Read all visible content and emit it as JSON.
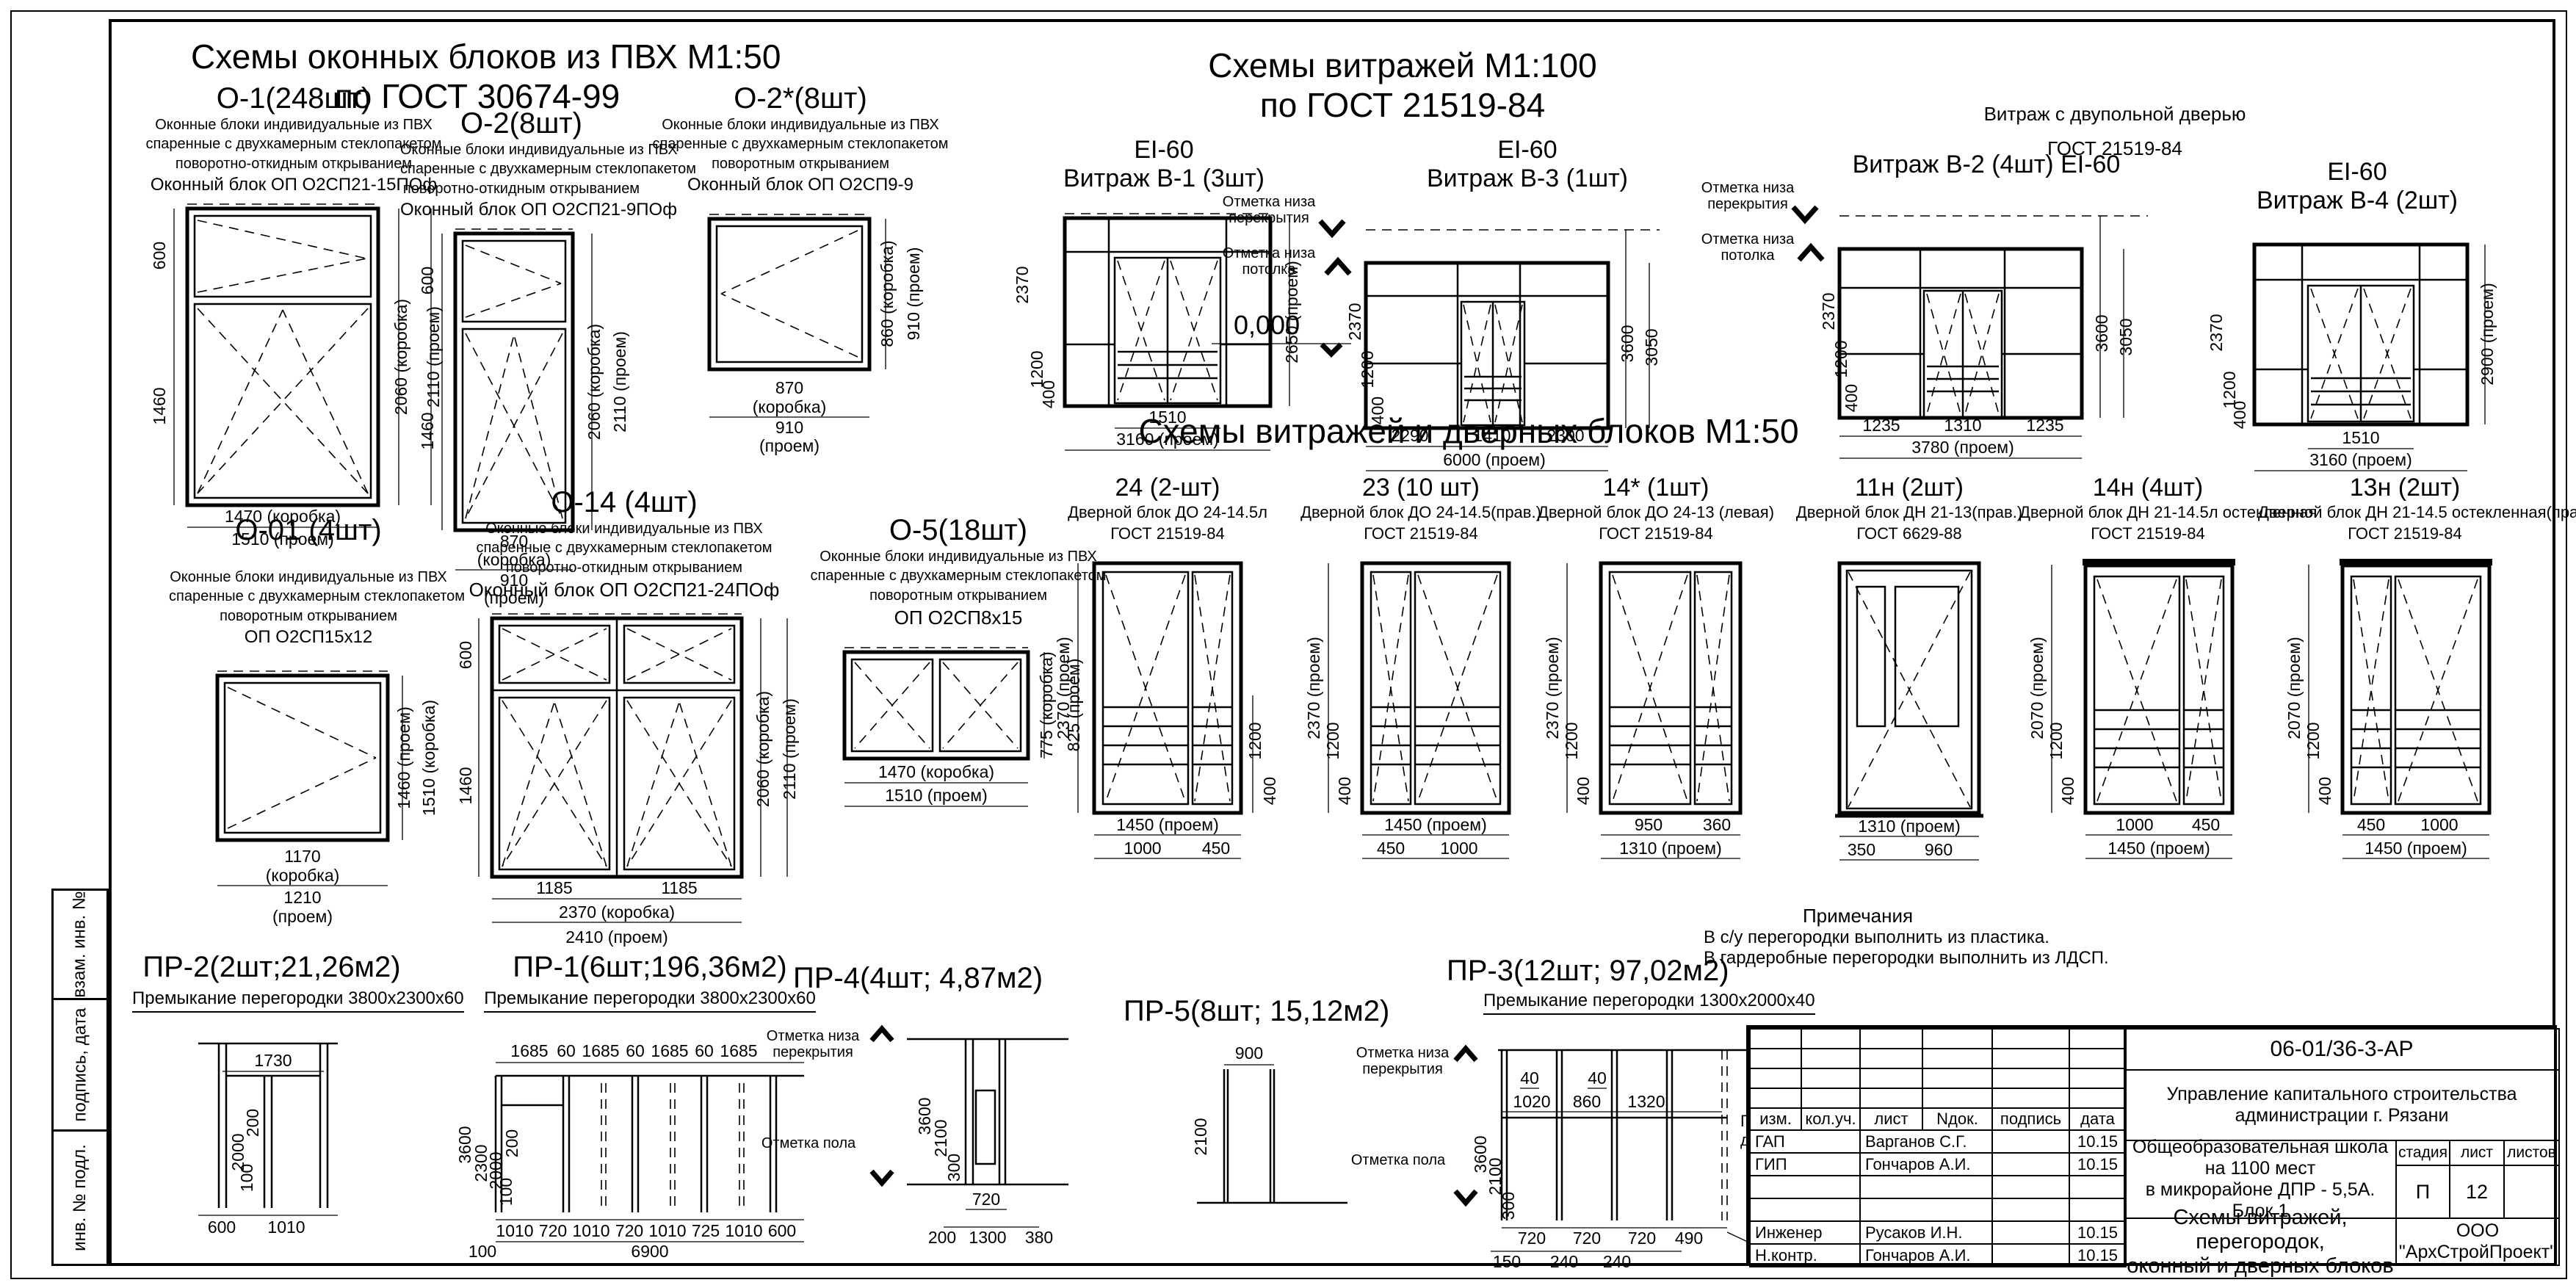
{
  "sheet": {
    "win_header": [
      "Схемы оконных  блоков из ПВХ М1:50",
      "по ГОСТ 30674-99"
    ],
    "vit_header": [
      "Схемы витражей М1:100",
      "по ГОСТ 21519-84"
    ],
    "vit_note": [
      "Витраж с двупольной дверью",
      "ГОСТ 21519-84"
    ],
    "doors_header": "Схемы витражей и дверных блоков М1:50",
    "side_labels": [
      "взам. инв. №",
      "подпись, дата",
      "инв. № подл."
    ]
  },
  "windows": {
    "o1": {
      "title": "О-1(248шт)",
      "desc": [
        "Оконные блоки индивидуальные из ПВХ",
        "спаренные с двухкамерным стеклопакетом",
        "поворотно-откидным открыванием",
        "Оконный блок ОП О2СП21-15ПОф"
      ],
      "dim_left_top": "600",
      "dim_left_bot": "1460",
      "dim_right_in": "2060 (коробка)",
      "dim_right_out": "2110 (проем)",
      "dim_bot_in": "1470 (коробка)",
      "dim_bot_out": "1510 (проем)"
    },
    "o2": {
      "title": "О-2(8шт)",
      "desc": [
        "Оконные блоки индивидуальные из ПВХ",
        "спаренные с двухкамерным стеклопакетом",
        "поворотно-откидным открыванием",
        "Оконный блок ОП О2СП21-9ПОф"
      ],
      "dim_left_top": "600",
      "dim_left_bot": "1460",
      "dim_right_in": "2060 (коробка)",
      "dim_right_out": "2110 (проем)",
      "dim_bot_in1": "870",
      "dim_bot_in2": "(коробка)",
      "dim_bot_out1": "910",
      "dim_bot_out2": "(проем)"
    },
    "o2s": {
      "title": "О-2*(8шт)",
      "desc": [
        "Оконные блоки индивидуальные из ПВХ",
        "спаренные с двухкамерным стеклопакетом",
        "поворотным открыванием",
        "Оконный блок ОП О2СП9-9"
      ],
      "dim_right_in": "860 (коробка)",
      "dim_right_out": "910 (проем)",
      "dim_bot_in1": "870",
      "dim_bot_in2": "(коробка)",
      "dim_bot_out1": "910",
      "dim_bot_out2": "(проем)"
    },
    "o01": {
      "title": "О-01 (4шт)",
      "desc": [
        "Оконные блоки индивидуальные из ПВХ",
        "спаренные с двухкамерным стеклопакетом",
        "поворотным открыванием",
        "ОП О2СП15х12"
      ],
      "dim_right_in": "1460 (проем)",
      "dim_right_out": "1510 (коробка)",
      "dim_bot_in1": "1170",
      "dim_bot_in2": "(коробка)",
      "dim_bot_out1": "1210",
      "dim_bot_out2": "(проем)"
    },
    "o14": {
      "title": "О-14 (4шт)",
      "desc": [
        "Оконные блоки индивидуальные из ПВХ",
        "спаренные с двухкамерным стеклопакетом",
        "поворотно-откидным открыванием",
        "Оконный блок ОП О2СП21-24ПОф"
      ],
      "dim_left_top": "600",
      "dim_left_bot": "1460",
      "dim_right_in": "2060 (коробка)",
      "dim_right_out": "2110 (проем)",
      "dim_bot_w1": "1185",
      "dim_bot_w2": "1185",
      "dim_bot_in": "2370 (коробка)",
      "dim_bot_out": "2410 (проем)"
    },
    "o5": {
      "title": "О-5(18шт)",
      "desc": [
        "Оконные блоки индивидуальные из ПВХ",
        "спаренные с двухкамерным стеклопакетом",
        "поворотным открыванием",
        "ОП О2СП8х15"
      ],
      "dim_right_in": "775 (коробка)",
      "dim_right_out": "825 (проем)",
      "dim_bot_in": "1470 (коробка)",
      "dim_bot_out": "1510 (проем)"
    }
  },
  "vitrages": {
    "v1": {
      "fire": "EI-60",
      "title": "Витраж В-1 (3шт)",
      "dl1": "2370",
      "dl2": "1200",
      "dl3": "400",
      "dr1": "2650 (проем)",
      "db1": "1510",
      "db2": "3160 (проем)"
    },
    "v3": {
      "fire": "EI-60",
      "title": "Витраж В-3 (1шт)",
      "mark_top": [
        "Отметка низа",
        "перекрытия"
      ],
      "mark_bot": [
        "Отметка низа",
        "потолка"
      ],
      "level": "0,000",
      "dl1": "2370",
      "dl2": "1200",
      "dl3": "400",
      "dr1": "3600",
      "dr2": "3050",
      "db1": "2290",
      "db2": "1410",
      "db3": "2300",
      "db4": "6000  (проем)"
    },
    "v2": {
      "title": "Витраж В-2 (4шт) EI-60",
      "mark_top": [
        "Отметка низа",
        "перекрытия"
      ],
      "mark_bot": [
        "Отметка низа",
        "потолка"
      ],
      "dl1": "2370",
      "dl2": "1200",
      "dl3": "400",
      "dr1": "3600",
      "dr2": "3050",
      "db1": "1235",
      "db2": "1310",
      "db3": "1235",
      "db4": "3780 (проем)"
    },
    "v4": {
      "fire": "EI-60",
      "title": "Витраж В-4 (2шт)",
      "dl1": "2370",
      "dl2": "1200",
      "dl3": "400",
      "dr1": "2900 (проем)",
      "db1": "1510",
      "db2": "3160 (проем)"
    }
  },
  "doors": {
    "d24": {
      "title": "24 (2-шт)",
      "desc": [
        "Дверной блок ДО 24-14.5л",
        "ГОСТ 21519-84"
      ],
      "dl": "2370  (проем)",
      "dm1": "1200",
      "dm2": "400",
      "db_top": "1450 (проем)",
      "db1": "1000",
      "db2": "450"
    },
    "d23": {
      "title": "23 (10 шт)",
      "desc": [
        "Дверной блок ДО 24-14.5(прав.)",
        "ГОСТ 21519-84"
      ],
      "dl": "2370  (проем)",
      "dm1": "1200",
      "dm2": "400",
      "db_top": "1450  (проем)",
      "db1": "450",
      "db2": "1000"
    },
    "d14s": {
      "title": "14* (1шт)",
      "desc": [
        "Дверной блок ДО 24-13 (левая)",
        "ГОСТ 21519-84"
      ],
      "dl": "2370  (проем)",
      "dm1": "1200",
      "dm2": "400",
      "db1": "950",
      "db2": "360",
      "db_bot": "1310  (проем)"
    },
    "d11n": {
      "title": "11н (2шт)",
      "desc": [
        "Дверной блок ДН 21-13(прав.)",
        "ГОСТ 6629-88"
      ],
      "db_top": "1310 (проем)",
      "db1": "350",
      "db2": "960"
    },
    "d14n": {
      "title": "14н (4шт)",
      "desc": [
        "Дверной блок ДН 21-14.5л остекленная",
        "ГОСТ 21519-84"
      ],
      "dl": "2070  (проем)",
      "dm1": "1200",
      "dm2": "400",
      "db1": "1000",
      "db2": "450",
      "db_bot": "1450  (проем)"
    },
    "d13n": {
      "title": "13н (2шт)",
      "desc": [
        "Дверной блок ДН 21-14.5 остекленная(прав.)",
        "ГОСТ 21519-84"
      ],
      "dl": "2070  (проем)",
      "dm1": "1200",
      "dm2": "400",
      "db1": "450",
      "db2": "1000",
      "db_bot": "1450  (проем)"
    }
  },
  "partitions": {
    "pr2": {
      "title": "ПР-2(2шт;21,26м2)",
      "sub": "Премыкание перегородки 3800х2300х60",
      "dt": "1730",
      "dl1": "2000",
      "dl2": "200",
      "dl3": "100",
      "db1": "600",
      "db2": "1010"
    },
    "pr1": {
      "title": "ПР-1(6шт;196,36м2)",
      "sub": "Премыкание перегородки 3800х2300х60",
      "dt": [
        "1685",
        "60",
        "1685",
        "60",
        "1685",
        "60",
        "1685"
      ],
      "dl1": "3600",
      "dl2": "2300",
      "dl3": "2000",
      "dl4": "200",
      "dl5": "100",
      "db": [
        "1010",
        "720",
        "1010",
        "720",
        "1010",
        "725",
        "1010",
        "600"
      ],
      "db_left": "100",
      "db_total": "6900"
    },
    "pr4": {
      "title": "ПР-4(4шт; 4,87м2)",
      "mark_top": [
        "Отметка низа",
        "перекрытия"
      ],
      "mark_bot": "Отметка пола",
      "dl1": "3600",
      "dl2": "2100",
      "dl3": "300",
      "dt": "720",
      "db1": "200",
      "db2": "1300",
      "db3": "380"
    },
    "pr5": {
      "title": "ПР-5(8шт; 15,12м2)",
      "dt": "900",
      "dl": "2100"
    },
    "pr3": {
      "title": "ПР-3(12шт; 97,02м2)",
      "sub": "Премыкание перегородки 1300х2000х40",
      "mark_top": [
        "Отметка низа",
        "перекрытия"
      ],
      "mark_bot": "Отметка пола",
      "g1": "40",
      "g2": "40",
      "dt1": "1020",
      "dt2": "860",
      "dt3": "1320",
      "note": [
        "Перегородка",
        "для 2, 3 и 4 этажей"
      ],
      "dl1": "3600",
      "dl2": "2100",
      "dl3": "300",
      "db1": "720",
      "db2": "720",
      "db3": "720",
      "db4": "490",
      "dr": "130",
      "dbb1": "150",
      "dbb2": "240",
      "dbb3": "240"
    }
  },
  "notes": {
    "title": "Примечания",
    "lines": [
      "В с/у перегородки выполнить из пластика.",
      "В гардеробные перегородки выполнить из ЛДСП."
    ]
  },
  "titleblock": {
    "code": "06-01/36-3-АР",
    "org": "Управление капитального строительства администрации г. Рязани",
    "cols": [
      "изм.",
      "кол.уч.",
      "лист",
      "Nдок.",
      "подпись",
      "дата"
    ],
    "rows": [
      {
        "role": "ГАП",
        "name": "Варганов С.Г.",
        "sign": "",
        "date": "10.15"
      },
      {
        "role": "ГИП",
        "name": "Гончаров А.И.",
        "sign": "",
        "date": "10.15"
      },
      {
        "role": "",
        "name": "",
        "sign": "",
        "date": ""
      },
      {
        "role": "",
        "name": "",
        "sign": "",
        "date": ""
      },
      {
        "role": "Инженер",
        "name": "Русаков И.Н.",
        "sign": "",
        "date": "10.15"
      },
      {
        "role": "Н.контр.",
        "name": "Гончаров А.И.",
        "sign": "",
        "date": "10.15"
      }
    ],
    "object": [
      "Общеобразовательная школа на 1100 мест",
      "в микрорайоне ДПР - 5,5А. Блок 1"
    ],
    "stage_cols": [
      "стадия",
      "лист",
      "листов"
    ],
    "stage": "П",
    "sheet_num": "12",
    "sheets_total": "",
    "doc_title": [
      "Схемы витражей, перегородок,",
      "оконный и дверных блоков"
    ],
    "company": "ООО \"АрхСтройПроект\""
  }
}
